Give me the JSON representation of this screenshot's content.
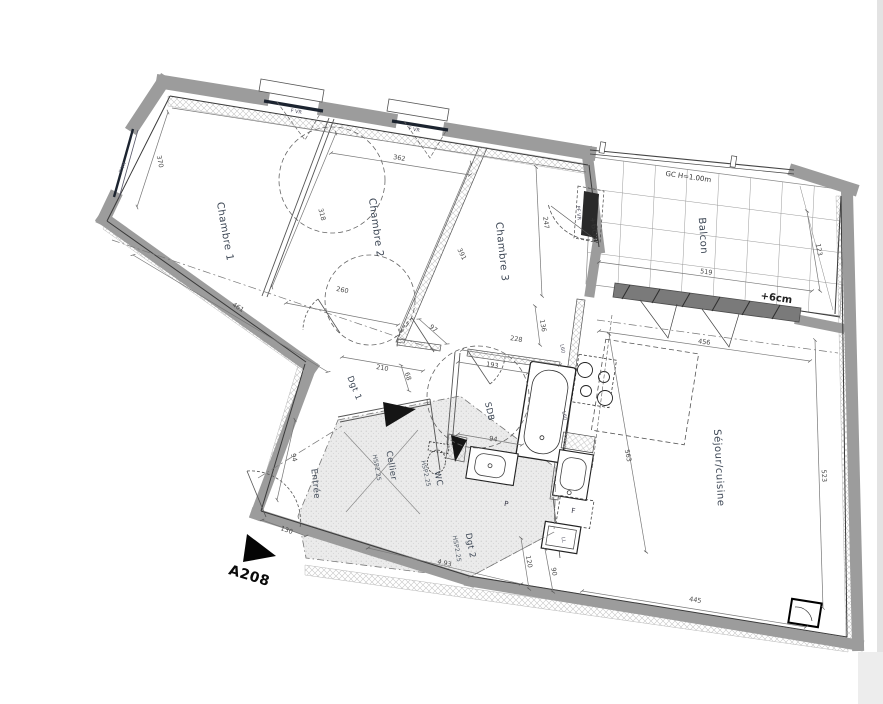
{
  "plan": {
    "unit": {
      "id": "A208"
    },
    "rooms": {
      "chambre1": "Chambre 1",
      "chambre2": "Chambre 2",
      "chambre3": "Chambre 3",
      "balcon": "Balcon",
      "sejour": "Séjour/cuisine",
      "entree": "Entrée",
      "cellier": "Cellier",
      "wc": "WC",
      "sdb": "SDB",
      "dgt1": "Dgt 1",
      "dgt2": "Dgt 2"
    },
    "notes": {
      "gc": "GC H=1.00m",
      "plus6_left": "+6cm",
      "plus6_right": "+6cm",
      "hsp_cellier": "HSP2.25",
      "hsp_wc": "HSP2.25",
      "hsp_dgt2": "HSP2.25",
      "pf_vr": "PF VR",
      "f_vr_1": "F VR",
      "f_vr_2": "F VR",
      "f_vr_3": "F VR",
      "fridge": "F",
      "placard": "P",
      "lavelinge": "LL",
      "l60_1": "L60",
      "l60_2": "L60"
    },
    "dims": {
      "ch1_left": "370",
      "ch1_bottom": "461",
      "ch2_top": "362",
      "ch1_ch2": "318",
      "ch2_bottom": "260",
      "ch2_ch3": "391",
      "ch3_right": "247",
      "ch3_bottom": "228",
      "ch3_low": "136",
      "sdb_top": "193",
      "sdb_bottom": "94",
      "dgt1_a": "97",
      "dgt1_b": "210",
      "dgt1_c": "68",
      "entree_wall": "94",
      "entree_door": "130",
      "dgt2_bottom": "4.93",
      "dgt2_a": "120",
      "dgt2_b": "90",
      "balcon_top": "519",
      "balcon_right": "123",
      "sejour_top": "456",
      "sejour_right": "523",
      "cuisine": "563",
      "sejour_bottom": "445"
    }
  }
}
